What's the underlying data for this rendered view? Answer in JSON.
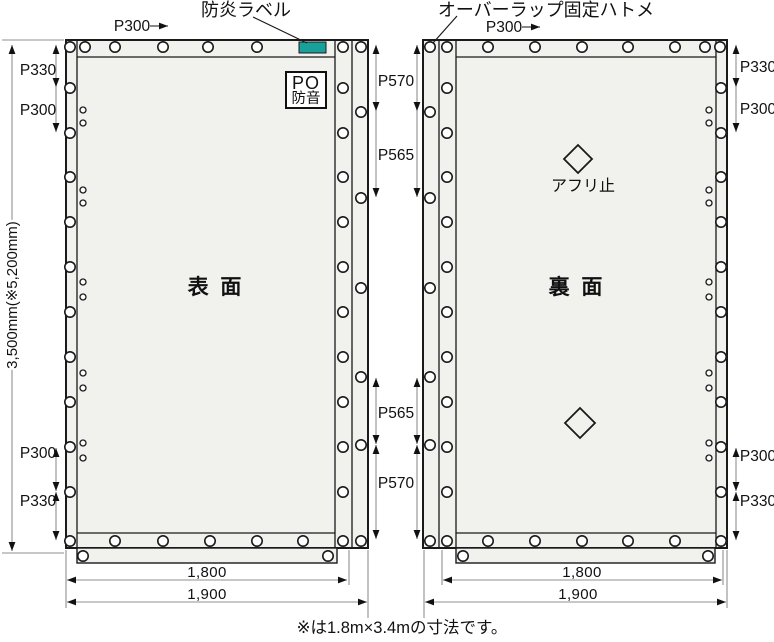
{
  "annotations": {
    "flame_label": "防炎ラベル",
    "overlap_label": "オーバーラップ固定ハトメ",
    "afuri_label": "アフリ止",
    "note": "※は1.8m×3.4mの寸法です。"
  },
  "panels": {
    "front": {
      "name": "表 面",
      "po_line1": "PO",
      "po_line2": "防音"
    },
    "back": {
      "name": "裏 面"
    }
  },
  "dimensions": {
    "height": "3,500mm(※5,200mm)",
    "front_pitch": "P300",
    "back_pitch": "P300",
    "left_top": [
      "P330",
      "P300"
    ],
    "left_bottom": [
      "P300",
      "P330"
    ],
    "right_top": [
      "P330",
      "P300"
    ],
    "right_bottom": [
      "P300",
      "P330"
    ],
    "mid_top": [
      "P570",
      "P565"
    ],
    "mid_bottom": [
      "P565",
      "P570"
    ],
    "front_width_inner": "1,800",
    "front_width_outer": "1,900",
    "back_width_inner": "1,800",
    "back_width_outer": "1,900"
  },
  "colors": {
    "panel_fill": "#f1f1ee",
    "line": "#1a1a1a",
    "dim_line": "#8f8f8f",
    "arrow": "#111111",
    "flame_tag": "#1aa09a",
    "background": "#ffffff"
  },
  "geometry": {
    "panels": [
      {
        "x": 66,
        "y": 40,
        "w": 302,
        "h": 508
      },
      {
        "x": 423,
        "y": 40,
        "w": 304,
        "h": 508
      }
    ],
    "flaps": [
      {
        "x": 77,
        "y": 548,
        "w": 260,
        "h": 15
      },
      {
        "x": 456,
        "y": 548,
        "w": 259,
        "h": 15
      }
    ],
    "inner_lines": [
      [
        77,
        40,
        77,
        548
      ],
      [
        335,
        40,
        335,
        548
      ],
      [
        352,
        40,
        352,
        548
      ],
      [
        77,
        57,
        335,
        57
      ],
      [
        77,
        533,
        335,
        533
      ],
      [
        439,
        40,
        439,
        548
      ],
      [
        456,
        40,
        456,
        548
      ],
      [
        716,
        40,
        716,
        548
      ],
      [
        456,
        57,
        716,
        57
      ],
      [
        456,
        533,
        716,
        533
      ]
    ],
    "flame_tag": {
      "x": 299,
      "y": 42,
      "w": 27,
      "h": 11
    },
    "diamonds": [
      [
        578,
        159,
        14
      ],
      [
        580,
        423,
        15
      ]
    ],
    "leader_lines": [
      [
        253,
        17,
        307,
        43
      ],
      [
        457,
        16,
        433,
        43
      ]
    ],
    "extension_lines": [
      [
        2,
        40,
        64,
        40
      ],
      [
        2,
        553,
        64,
        553
      ],
      [
        66,
        550,
        66,
        608
      ],
      [
        349,
        550,
        349,
        585
      ],
      [
        368,
        550,
        368,
        618
      ],
      [
        424,
        550,
        424,
        618
      ],
      [
        442,
        550,
        442,
        585
      ],
      [
        723,
        550,
        723,
        585
      ],
      [
        727,
        550,
        727,
        608
      ]
    ],
    "dim_segments": [
      {
        "x1": 12,
        "y1": 45,
        "x2": 12,
        "y2": 551,
        "a1": "up",
        "a2": "down"
      },
      {
        "x1": 56,
        "y1": 45,
        "x2": 56,
        "y2": 87,
        "a1": "up",
        "a2": "down"
      },
      {
        "x1": 56,
        "y1": 87,
        "x2": 56,
        "y2": 132,
        "a1": "none",
        "a2": "down"
      },
      {
        "x1": 56,
        "y1": 448,
        "x2": 56,
        "y2": 491,
        "a1": "up",
        "a2": "down"
      },
      {
        "x1": 56,
        "y1": 492,
        "x2": 56,
        "y2": 540,
        "a1": "up",
        "a2": "down"
      },
      {
        "x1": 736,
        "y1": 45,
        "x2": 736,
        "y2": 87,
        "a1": "up",
        "a2": "down"
      },
      {
        "x1": 736,
        "y1": 87,
        "x2": 736,
        "y2": 132,
        "a1": "none",
        "a2": "down"
      },
      {
        "x1": 736,
        "y1": 448,
        "x2": 736,
        "y2": 491,
        "a1": "up",
        "a2": "down"
      },
      {
        "x1": 736,
        "y1": 492,
        "x2": 736,
        "y2": 540,
        "a1": "up",
        "a2": "down"
      },
      {
        "x1": 376,
        "y1": 45,
        "x2": 376,
        "y2": 111,
        "a1": "up",
        "a2": "down"
      },
      {
        "x1": 376,
        "y1": 111,
        "x2": 376,
        "y2": 197,
        "a1": "none",
        "a2": "down"
      },
      {
        "x1": 376,
        "y1": 378,
        "x2": 376,
        "y2": 444,
        "a1": "up",
        "a2": "down"
      },
      {
        "x1": 376,
        "y1": 445,
        "x2": 376,
        "y2": 539,
        "a1": "up",
        "a2": "down"
      },
      {
        "x1": 417,
        "y1": 45,
        "x2": 417,
        "y2": 111,
        "a1": "up",
        "a2": "down"
      },
      {
        "x1": 417,
        "y1": 111,
        "x2": 417,
        "y2": 197,
        "a1": "none",
        "a2": "down"
      },
      {
        "x1": 417,
        "y1": 378,
        "x2": 417,
        "y2": 444,
        "a1": "up",
        "a2": "down"
      },
      {
        "x1": 417,
        "y1": 445,
        "x2": 417,
        "y2": 539,
        "a1": "up",
        "a2": "down"
      },
      {
        "x1": 150,
        "y1": 26,
        "x2": 168,
        "y2": 26,
        "a1": "none",
        "a2": "right",
        "b": true
      },
      {
        "x1": 522,
        "y1": 27,
        "x2": 540,
        "y2": 27,
        "a1": "none",
        "a2": "right",
        "b": true
      },
      {
        "x1": 67,
        "y1": 580,
        "x2": 347,
        "y2": 580,
        "a1": "left",
        "a2": "right"
      },
      {
        "x1": 67,
        "y1": 602,
        "x2": 367,
        "y2": 602,
        "a1": "left",
        "a2": "right"
      },
      {
        "x1": 443,
        "y1": 580,
        "x2": 722,
        "y2": 580,
        "a1": "left",
        "a2": "right"
      },
      {
        "x1": 425,
        "y1": 602,
        "x2": 726,
        "y2": 602,
        "a1": "left",
        "a2": "right"
      }
    ],
    "eyelets_large": [
      [
        70,
        47
      ],
      [
        85,
        47
      ],
      [
        115,
        47
      ],
      [
        163,
        47
      ],
      [
        208,
        47
      ],
      [
        257,
        47
      ],
      [
        343,
        47
      ],
      [
        361,
        47
      ],
      [
        70,
        541
      ],
      [
        115,
        541
      ],
      [
        163,
        541
      ],
      [
        210,
        541
      ],
      [
        257,
        541
      ],
      [
        303,
        541
      ],
      [
        343,
        541
      ],
      [
        361,
        541
      ],
      [
        70,
        88
      ],
      [
        70,
        133
      ],
      [
        70,
        177
      ],
      [
        70,
        222
      ],
      [
        70,
        267
      ],
      [
        70,
        312
      ],
      [
        70,
        357
      ],
      [
        70,
        402
      ],
      [
        70,
        447
      ],
      [
        70,
        492
      ],
      [
        343,
        88
      ],
      [
        343,
        133
      ],
      [
        343,
        177
      ],
      [
        343,
        222
      ],
      [
        343,
        267
      ],
      [
        343,
        312
      ],
      [
        343,
        357
      ],
      [
        343,
        402
      ],
      [
        343,
        447
      ],
      [
        343,
        492
      ],
      [
        361,
        112
      ],
      [
        361,
        198
      ],
      [
        361,
        288
      ],
      [
        361,
        377
      ],
      [
        361,
        445
      ],
      [
        430,
        47
      ],
      [
        447,
        47
      ],
      [
        488,
        47
      ],
      [
        535,
        47
      ],
      [
        582,
        47
      ],
      [
        628,
        47
      ],
      [
        675,
        47
      ],
      [
        705,
        47
      ],
      [
        720,
        47
      ],
      [
        430,
        541
      ],
      [
        447,
        541
      ],
      [
        488,
        541
      ],
      [
        535,
        541
      ],
      [
        582,
        541
      ],
      [
        628,
        541
      ],
      [
        675,
        541
      ],
      [
        721,
        541
      ],
      [
        447,
        88
      ],
      [
        447,
        133
      ],
      [
        447,
        177
      ],
      [
        447,
        222
      ],
      [
        447,
        267
      ],
      [
        447,
        312
      ],
      [
        447,
        357
      ],
      [
        447,
        402
      ],
      [
        447,
        447
      ],
      [
        447,
        492
      ],
      [
        430,
        112
      ],
      [
        430,
        198
      ],
      [
        430,
        288
      ],
      [
        430,
        377
      ],
      [
        430,
        445
      ],
      [
        721,
        88
      ],
      [
        721,
        133
      ],
      [
        721,
        177
      ],
      [
        721,
        222
      ],
      [
        721,
        267
      ],
      [
        721,
        312
      ],
      [
        721,
        357
      ],
      [
        721,
        402
      ],
      [
        721,
        447
      ],
      [
        721,
        492
      ],
      [
        83,
        556
      ],
      [
        328,
        556
      ],
      [
        463,
        556
      ],
      [
        708,
        556
      ]
    ],
    "eyelets_small": [
      [
        83,
        110
      ],
      [
        83,
        123
      ],
      [
        83,
        190
      ],
      [
        83,
        203
      ],
      [
        83,
        282
      ],
      [
        83,
        297
      ],
      [
        83,
        373
      ],
      [
        83,
        388
      ],
      [
        83,
        443
      ],
      [
        83,
        458
      ],
      [
        709,
        110
      ],
      [
        709,
        123
      ],
      [
        709,
        190
      ],
      [
        709,
        203
      ],
      [
        709,
        282
      ],
      [
        709,
        297
      ],
      [
        709,
        373
      ],
      [
        709,
        388
      ],
      [
        709,
        443
      ],
      [
        709,
        458
      ]
    ]
  }
}
